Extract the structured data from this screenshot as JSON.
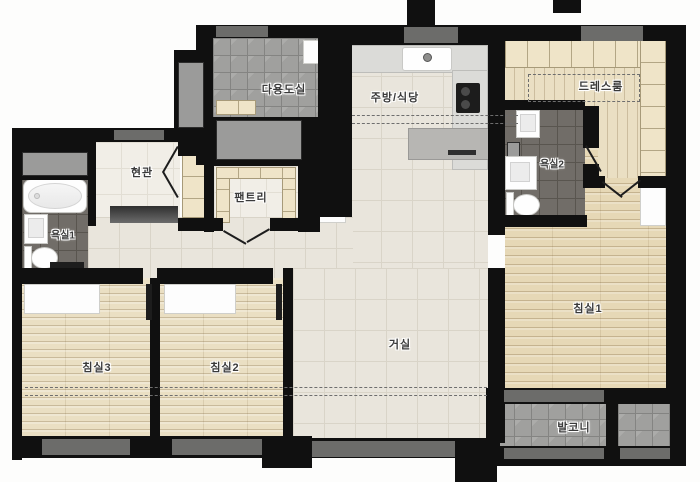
{
  "floorplan": {
    "rooms": [
      {
        "id": "utility",
        "label": "다용도실"
      },
      {
        "id": "kitchen_dining",
        "label": "주방/식당"
      },
      {
        "id": "dressroom",
        "label": "드레스룸"
      },
      {
        "id": "entrance",
        "label": "현관"
      },
      {
        "id": "pantry",
        "label": "팬트리"
      },
      {
        "id": "bath1",
        "label": "욕실1"
      },
      {
        "id": "bath2",
        "label": "욕실2"
      },
      {
        "id": "bedroom3",
        "label": "침실3"
      },
      {
        "id": "bedroom2",
        "label": "침실2"
      },
      {
        "id": "living",
        "label": "거실"
      },
      {
        "id": "bedroom1",
        "label": "침실1"
      },
      {
        "id": "balcony",
        "label": "발코니"
      }
    ],
    "fixtures": [
      "bathtub",
      "toilet",
      "wash-basin",
      "cooktop",
      "kitchen-sink",
      "kitchen-island",
      "refrigerator-cabinet",
      "shoe-cabinet",
      "pantry-shelves",
      "wardrobe",
      "doormat",
      "door-swing",
      "window",
      "closet"
    ],
    "palette": {
      "wall": "#101010",
      "floor_tile_beige": "#e9e5dc",
      "floor_tile_light": "#f1eee7",
      "wood_floor": "#eadfc3",
      "wood_floor_warm": "#e6d8b6",
      "wardrobe_wood": "#efe4c8",
      "bath_tile_dark": "#716d68",
      "gray_tile": "#a0a09e",
      "window_gray": "#a5a5a3",
      "fixture_white": "#fefefe",
      "label_text": "#3a3a3a"
    }
  }
}
